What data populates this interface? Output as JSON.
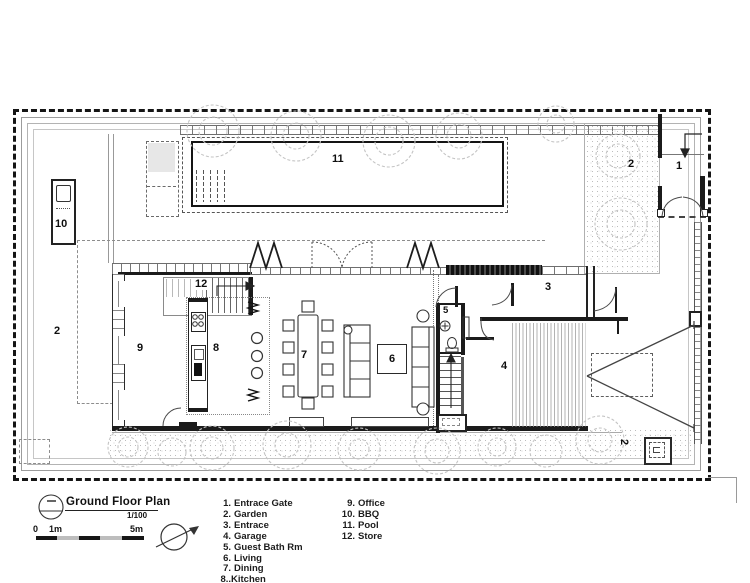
{
  "title_block": {
    "title": "Ground Floor Plan",
    "scale": "1/100"
  },
  "scale_bar": {
    "zero": "0",
    "one_m": "1m",
    "five_m": "5m"
  },
  "rooms": {
    "entrance_gate": "1",
    "garden_left": "2",
    "garden_right": "2",
    "garden_bottom": "2",
    "entrance": "3",
    "garage": "4",
    "guest_bath": "5",
    "living": "6",
    "dining": "7",
    "kitchen": "8",
    "office": "9",
    "bbq": "10",
    "pool": "11",
    "store": "12"
  },
  "legend": {
    "col1": [
      {
        "num": "1.",
        "name": "Entrace Gate"
      },
      {
        "num": "2.",
        "name": "Garden"
      },
      {
        "num": "3.",
        "name": "Entrace"
      },
      {
        "num": "4.",
        "name": "Garage"
      },
      {
        "num": "5.",
        "name": "Guest Bath Rm"
      },
      {
        "num": "6.",
        "name": "Living"
      },
      {
        "num": "7.",
        "name": "Dining"
      },
      {
        "num": "8..",
        "name": "Kitchen"
      }
    ],
    "col2": [
      {
        "num": "9.",
        "name": "Office"
      },
      {
        "num": "10.",
        "name": "BBQ"
      },
      {
        "num": "11.",
        "name": "Pool"
      },
      {
        "num": "12.",
        "name": "Store"
      }
    ]
  },
  "colors": {
    "line": "#1b1b1b",
    "fence": "#9c9c9c",
    "stipple": "#bdbdbd"
  }
}
